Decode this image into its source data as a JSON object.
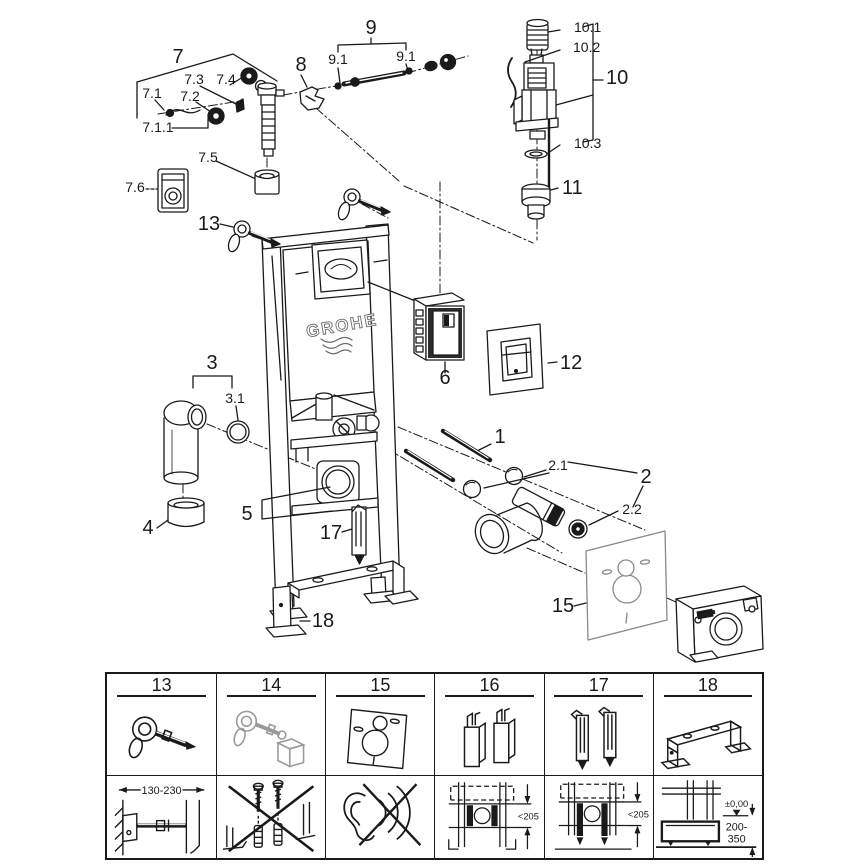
{
  "page": {
    "background": "#ffffff",
    "ink": "#1a1a1a",
    "muted": "#9a9a9a"
  },
  "diagram": {
    "brand_logo": "GROHE",
    "adapter_badge": "GROHE",
    "callouts": {
      "c1": "1",
      "c2": "2",
      "c21": "2.1",
      "c22": "2.2",
      "c3": "3",
      "c31": "3.1",
      "c4": "4",
      "c5": "5",
      "c6": "6",
      "c7": "7",
      "c71": "7.1",
      "c711": "7.1.1",
      "c72": "7.2",
      "c73": "7.3",
      "c74": "7.4",
      "c75": "7.5",
      "c76": "7.6",
      "c8": "8",
      "c9": "9",
      "c91": "9.1",
      "c10": "10",
      "c101": "10.1",
      "c102": "10.2",
      "c103": "10.3",
      "c11": "11",
      "c12": "12",
      "c13": "13",
      "c15": "15",
      "c17": "17",
      "c18": "18"
    }
  },
  "table": {
    "columns": [
      {
        "label": "13",
        "dims": {
          "range": "130-230"
        }
      },
      {
        "label": "14",
        "dims": {}
      },
      {
        "label": "15",
        "dims": {}
      },
      {
        "label": "16",
        "dims": {
          "depth": "<205"
        }
      },
      {
        "label": "17",
        "dims": {
          "depth": "<205"
        }
      },
      {
        "label": "18",
        "dims": {
          "level": "±0,00",
          "range1": "200-",
          "range2": "350"
        }
      }
    ]
  }
}
